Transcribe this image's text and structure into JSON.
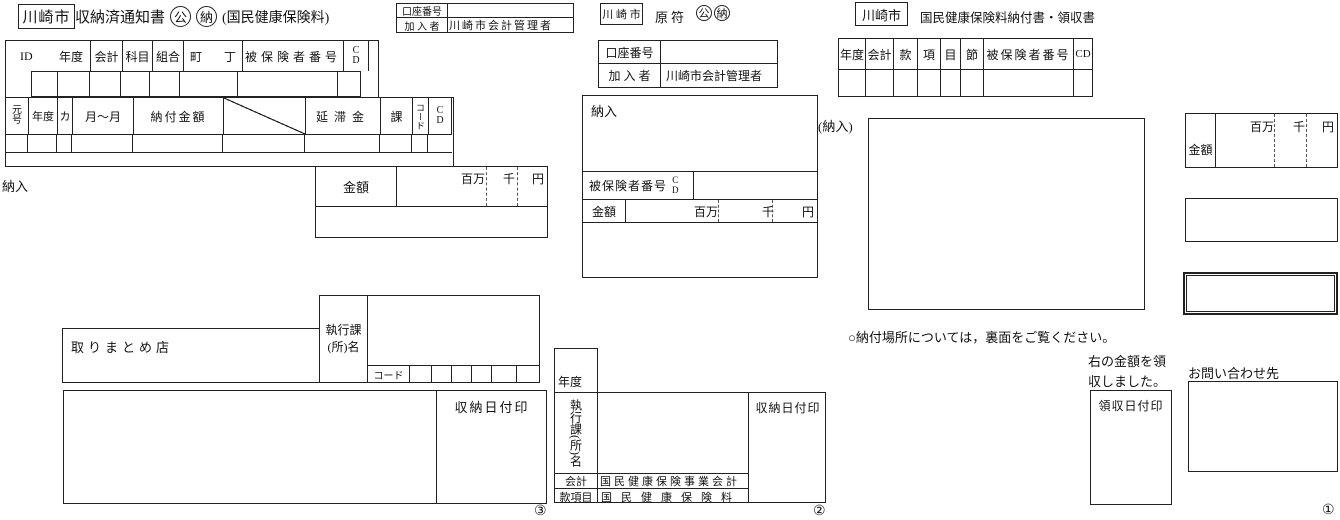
{
  "form3": {
    "city": "川崎市",
    "title": "収納済通知書",
    "mark_kou": "公",
    "mark_nou": "納",
    "subtitle": "(国民健康保険料)",
    "account": {
      "row1_label": "口座番号",
      "row1_value": "",
      "row2_label": "加 入 者",
      "row2_value": "川崎市会計管理者"
    },
    "table1": {
      "col_id": "ID",
      "col_nendo": "年度",
      "col_kaikei": "会計",
      "col_kamoku": "科目",
      "col_kumiai": "組合",
      "col_cho": "町",
      "col_chome": "丁",
      "col_hihokensha": "被保険者番号",
      "col_cd_c": "C",
      "col_cd_d": "D"
    },
    "table2": {
      "col_gengo_top": "元",
      "col_gengo_bottom": "号",
      "col_nendo": "年度",
      "col_ka": "カ",
      "col_tsuki": "月〜月",
      "col_noufu": "納付金額",
      "col_entai": "延滞金",
      "col_kacol": "課",
      "col_code": "コード",
      "col_cd_c": "C",
      "col_cd_d": "D"
    },
    "nounyuu_label": "納入",
    "amount": {
      "label": "金額",
      "unit_million": "百万",
      "unit_thousand": "千",
      "unit_yen": "円"
    },
    "torimatome_label": "取りまとめ店",
    "shikkou_line1": "執行課",
    "shikkou_line2": "(所)名",
    "code_label": "コード",
    "stamp_label": "収納日付印",
    "marker": "③"
  },
  "form2": {
    "city": "川 崎 市",
    "title": "原符",
    "mark_kou": "公",
    "mark_nou": "納",
    "account": {
      "row1_label": "口座番号",
      "row1_value": "",
      "row2_label": "加 入 者",
      "row2_value": "川崎市会計管理者"
    },
    "nounyuu_label": "納入",
    "insured_label": "被保険者番号",
    "cd_c": "C",
    "cd_d": "D",
    "amount": {
      "label": "金額",
      "unit_million": "百万",
      "unit_thousand": "千",
      "unit_yen": "円"
    },
    "nendo_label": "年度",
    "shikkou_vertical": "執行課(所)名",
    "kaikei_label": "会計",
    "kaikei_value": "国民健康保険事業会計",
    "kankomoku_label": "款項目",
    "kankomoku_value": "国民健康保険料",
    "stamp_label": "収納日付印",
    "marker": "②"
  },
  "form1": {
    "city": "川崎市",
    "title": "国民健康保険料納付書・領収書",
    "table": {
      "col_nendo": "年度",
      "col_kaikei": "会計",
      "col_kan": "款",
      "col_ko": "項",
      "col_moku": "目",
      "col_setsu": "節",
      "col_hihokensha": "被保険者番号",
      "col_cd": "CD"
    },
    "nounyuu_label": "(納入)",
    "amount": {
      "label": "金額",
      "unit_million": "百万",
      "unit_thousand": "千",
      "unit_yen": "円"
    },
    "note": "○納付場所については，裏面をご覧ください。",
    "received_note": "右の金額を領収しました。",
    "stamp_label": "領収日付印",
    "inquiry_label": "お問い合わせ先",
    "marker": "①"
  }
}
